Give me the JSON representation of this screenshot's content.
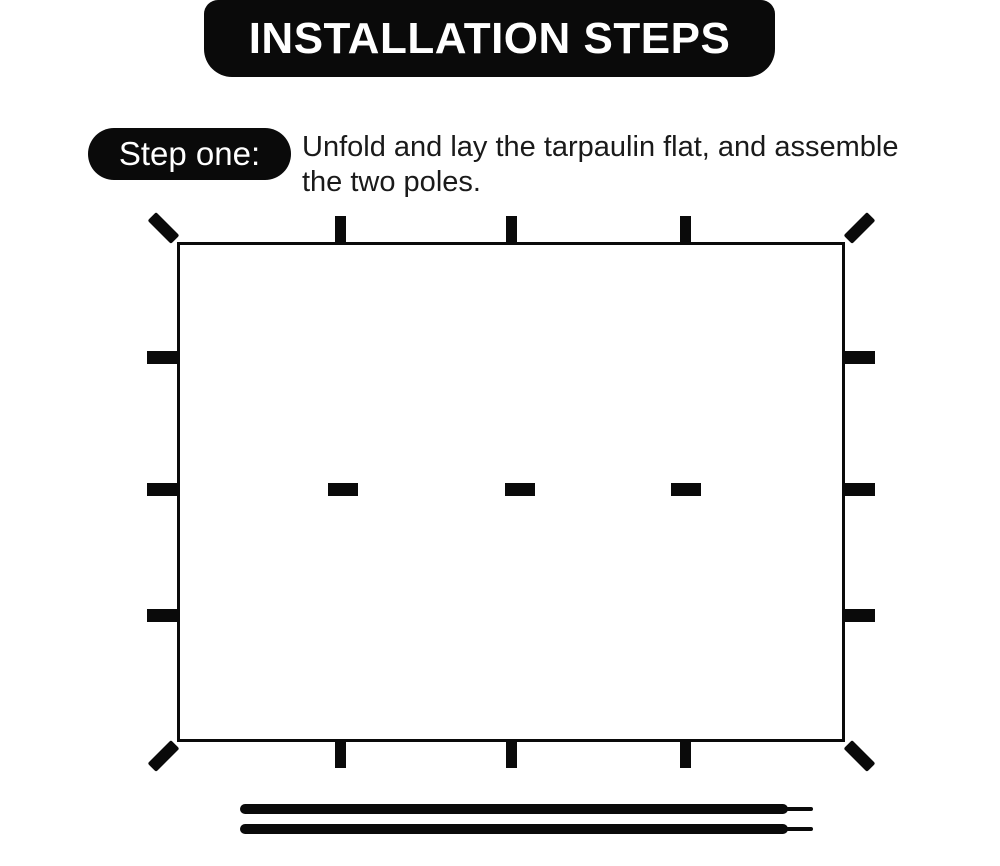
{
  "colors": {
    "ink": "#0a0a0a",
    "background": "#ffffff",
    "text": "#1a1a1a"
  },
  "header": {
    "title": "INSTALLATION STEPS"
  },
  "step": {
    "label": "Step one:",
    "description_line1": "Unfold and lay the tarpaulin flat, and assemble",
    "description_line2": "the two poles."
  },
  "diagram": {
    "rect": {
      "left": 177,
      "top": 242,
      "width": 668,
      "height": 500
    },
    "edge_tab_vertical": {
      "w": 11,
      "h": 26
    },
    "edge_tab_horizontal": {
      "w": 30,
      "h": 13
    },
    "inner_tab": {
      "w": 30,
      "h": 13
    },
    "corner_tab": {
      "long": 33,
      "thick": 12,
      "offset": 14
    },
    "top_tab_centers_x": [
      340,
      511,
      685
    ],
    "bottom_tab_centers_x": [
      340,
      511,
      685
    ],
    "left_tab_centers_y": [
      357,
      489,
      615
    ],
    "right_tab_centers_y": [
      357,
      489,
      615
    ],
    "inner_tab_centers": [
      {
        "x": 343,
        "y": 489
      },
      {
        "x": 520,
        "y": 489
      },
      {
        "x": 686,
        "y": 489
      }
    ],
    "poles": [
      {
        "x": 240,
        "y": 804,
        "length": 548,
        "thickness": 10,
        "tip_length": 25,
        "tip_thickness": 4
      },
      {
        "x": 240,
        "y": 824,
        "length": 548,
        "thickness": 10,
        "tip_length": 25,
        "tip_thickness": 4
      }
    ]
  }
}
